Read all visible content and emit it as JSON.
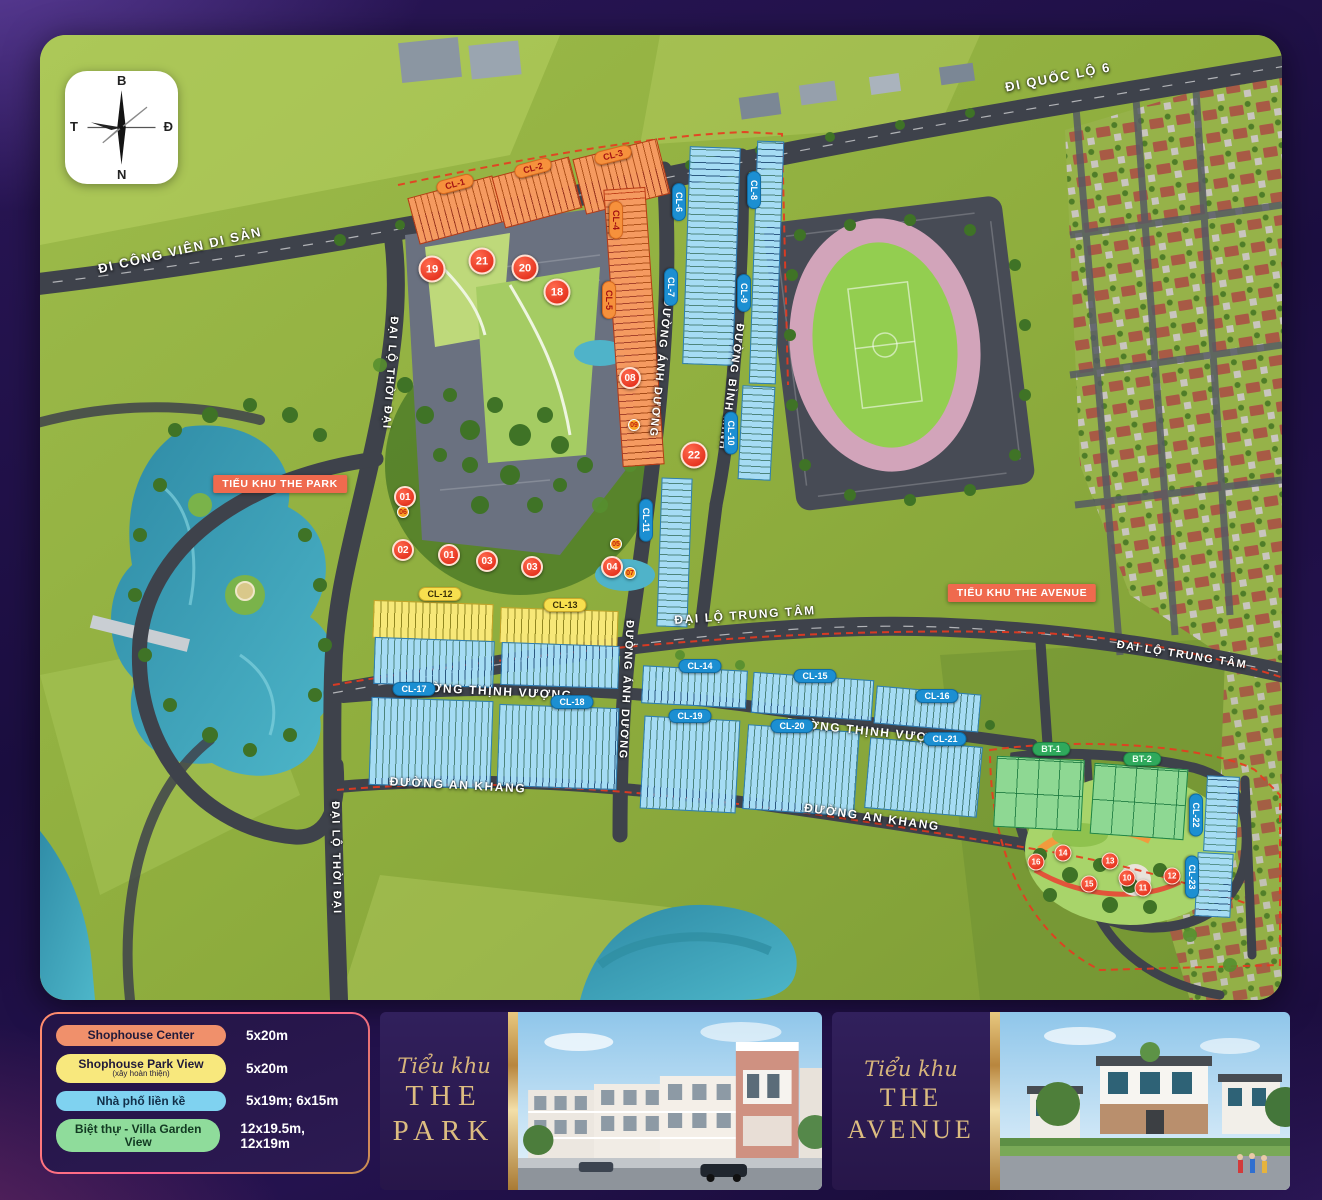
{
  "compass": {
    "north": "B",
    "east": "Đ",
    "south": "N",
    "west": "T"
  },
  "map": {
    "area_labels": [
      {
        "id": "the-park",
        "text": "TIỂU KHU THE PARK",
        "x": 240,
        "y": 449
      },
      {
        "id": "the-avenue",
        "text": "TIỂU KHU THE AVENUE",
        "x": 982,
        "y": 558
      }
    ],
    "road_labels": [
      {
        "id": "di-cong-vien-di-san",
        "text": "ĐI CÔNG VIÊN DI SẢN",
        "x": 140,
        "y": 215,
        "rot": -13,
        "fs": 13
      },
      {
        "id": "di-quoc-lo-6",
        "text": "ĐI QUỐC LỘ 6",
        "x": 1018,
        "y": 42,
        "rot": -11,
        "fs": 13
      },
      {
        "id": "dai-lo-thoi-dai-top",
        "text": "ĐẠI LỘ THỜI ĐẠI",
        "x": 350,
        "y": 338,
        "rot": 94,
        "fs": 11
      },
      {
        "id": "dai-lo-thoi-dai-bottom",
        "text": "ĐẠI LỘ THỜI ĐẠI",
        "x": 296,
        "y": 823,
        "rot": 89,
        "fs": 11
      },
      {
        "id": "duong-anh-duong-top",
        "text": "ĐƯỜNG ÁNH DƯƠNG",
        "x": 620,
        "y": 333,
        "rot": 96,
        "fs": 11
      },
      {
        "id": "duong-anh-duong-mid",
        "text": "ĐƯỜNG ÁNH DƯƠNG",
        "x": 586,
        "y": 655,
        "rot": 93,
        "fs": 11
      },
      {
        "id": "duong-binh-minh",
        "text": "ĐƯỜNG BÌNH MINH",
        "x": 691,
        "y": 352,
        "rot": 98,
        "fs": 11
      },
      {
        "id": "dai-lo-trung-tam-center",
        "text": "ĐẠI LỘ TRUNG TÂM",
        "x": 705,
        "y": 580,
        "rot": -4,
        "fs": 12
      },
      {
        "id": "dai-lo-trung-tam-right",
        "text": "ĐẠI LỘ TRUNG TÂM",
        "x": 1142,
        "y": 620,
        "rot": 9,
        "fs": 11
      },
      {
        "id": "duong-thinh-vuong-left",
        "text": "ĐƯỜNG THỊNH VƯỢNG",
        "x": 451,
        "y": 656,
        "rot": 3,
        "fs": 12
      },
      {
        "id": "duong-thinh-vuong-right",
        "text": "ĐƯỜNG THỊNH VƯỢNG",
        "x": 828,
        "y": 696,
        "rot": 6,
        "fs": 12
      },
      {
        "id": "duong-an-khang-left",
        "text": "ĐƯỜNG AN KHANG",
        "x": 418,
        "y": 750,
        "rot": 3,
        "fs": 12
      },
      {
        "id": "duong-an-khang-right",
        "text": "ĐƯỜNG AN KHANG",
        "x": 832,
        "y": 782,
        "rot": 8,
        "fs": 12
      }
    ],
    "block_labels": [
      {
        "id": "cl-1",
        "text": "CL-1",
        "x": 415,
        "y": 149,
        "rot": -15,
        "c": "orange"
      },
      {
        "id": "cl-2",
        "text": "CL-2",
        "x": 493,
        "y": 133,
        "rot": -15,
        "c": "orange"
      },
      {
        "id": "cl-3",
        "text": "CL-3",
        "x": 573,
        "y": 120,
        "rot": -14,
        "c": "orange"
      },
      {
        "id": "cl-4",
        "text": "CL-4",
        "x": 576,
        "y": 185,
        "rot": 90,
        "c": "orange"
      },
      {
        "id": "cl-5",
        "text": "CL-5",
        "x": 569,
        "y": 265,
        "rot": 90,
        "c": "orange"
      },
      {
        "id": "cl-6",
        "text": "CL-6",
        "x": 639,
        "y": 167,
        "rot": 90,
        "c": "blue"
      },
      {
        "id": "cl-7",
        "text": "CL-7",
        "x": 631,
        "y": 252,
        "rot": 90,
        "c": "blue"
      },
      {
        "id": "cl-8",
        "text": "CL-8",
        "x": 714,
        "y": 155,
        "rot": 90,
        "c": "blue"
      },
      {
        "id": "cl-9",
        "text": "CL-9",
        "x": 704,
        "y": 258,
        "rot": 90,
        "c": "blue"
      },
      {
        "id": "cl-10",
        "text": "CL-10",
        "x": 691,
        "y": 398,
        "rot": 90,
        "c": "blue"
      },
      {
        "id": "cl-11",
        "text": "CL-11",
        "x": 606,
        "y": 485,
        "rot": 90,
        "c": "blue"
      },
      {
        "id": "cl-12",
        "text": "CL-12",
        "x": 400,
        "y": 559,
        "rot": 0,
        "c": "yellow"
      },
      {
        "id": "cl-13",
        "text": "CL-13",
        "x": 525,
        "y": 570,
        "rot": 0,
        "c": "yellow"
      },
      {
        "id": "cl-14",
        "text": "CL-14",
        "x": 660,
        "y": 631,
        "rot": 0,
        "c": "blue"
      },
      {
        "id": "cl-15",
        "text": "CL-15",
        "x": 775,
        "y": 641,
        "rot": 0,
        "c": "blue"
      },
      {
        "id": "cl-16",
        "text": "CL-16",
        "x": 897,
        "y": 661,
        "rot": 0,
        "c": "blue"
      },
      {
        "id": "cl-17",
        "text": "CL-17",
        "x": 374,
        "y": 654,
        "rot": 0,
        "c": "blue"
      },
      {
        "id": "cl-18",
        "text": "CL-18",
        "x": 532,
        "y": 667,
        "rot": 0,
        "c": "blue"
      },
      {
        "id": "cl-19",
        "text": "CL-19",
        "x": 650,
        "y": 681,
        "rot": 0,
        "c": "blue"
      },
      {
        "id": "cl-20",
        "text": "CL-20",
        "x": 752,
        "y": 691,
        "rot": 0,
        "c": "blue"
      },
      {
        "id": "cl-21",
        "text": "CL-21",
        "x": 905,
        "y": 704,
        "rot": 0,
        "c": "blue"
      },
      {
        "id": "bt-1",
        "text": "BT-1",
        "x": 1011,
        "y": 714,
        "rot": 0,
        "c": "green"
      },
      {
        "id": "bt-2",
        "text": "BT-2",
        "x": 1102,
        "y": 724,
        "rot": 0,
        "c": "green"
      },
      {
        "id": "cl-22",
        "text": "CL-22",
        "x": 1156,
        "y": 780,
        "rot": 90,
        "c": "blue"
      },
      {
        "id": "cl-23",
        "text": "CL-23",
        "x": 1152,
        "y": 842,
        "rot": 90,
        "c": "blue"
      }
    ],
    "blocks": [
      {
        "id": "cl-1",
        "x": 372,
        "y": 151,
        "w": 88,
        "h": 48,
        "rot": -15,
        "c": "orange",
        "dir": "v"
      },
      {
        "id": "cl-2",
        "x": 457,
        "y": 131,
        "w": 80,
        "h": 53,
        "rot": -15,
        "c": "orange",
        "dir": "v"
      },
      {
        "id": "cl-3",
        "x": 538,
        "y": 113,
        "w": 87,
        "h": 57,
        "rot": -14,
        "c": "orange",
        "dir": "v"
      },
      {
        "id": "cl-4-5",
        "x": 573,
        "y": 153,
        "w": 42,
        "h": 278,
        "rot": -4,
        "c": "orange",
        "dir": "h"
      },
      {
        "id": "cl-6-7",
        "x": 646,
        "y": 112,
        "w": 51,
        "h": 218,
        "rot": 2,
        "c": "blue",
        "dir": "h"
      },
      {
        "id": "cl-8-9",
        "x": 713,
        "y": 106,
        "w": 27,
        "h": 243,
        "rot": 2,
        "c": "blue",
        "dir": "h"
      },
      {
        "id": "cl-10",
        "x": 700,
        "y": 351,
        "w": 33,
        "h": 94,
        "rot": 3,
        "c": "blue",
        "dir": "h"
      },
      {
        "id": "cl-11",
        "x": 619,
        "y": 443,
        "w": 31,
        "h": 149,
        "rot": 2,
        "c": "blue",
        "dir": "h"
      },
      {
        "id": "cl-12-sh",
        "x": 333,
        "y": 567,
        "w": 120,
        "h": 38,
        "rot": 2,
        "c": "yellow",
        "dir": "v"
      },
      {
        "id": "cl-12-lk",
        "x": 334,
        "y": 604,
        "w": 120,
        "h": 47,
        "rot": 2,
        "c": "blue",
        "dir": "v"
      },
      {
        "id": "cl-13-sh",
        "x": 460,
        "y": 574,
        "w": 118,
        "h": 36,
        "rot": 2,
        "c": "yellow",
        "dir": "v"
      },
      {
        "id": "cl-13-lk",
        "x": 461,
        "y": 609,
        "w": 118,
        "h": 43,
        "rot": 2,
        "c": "blue",
        "dir": "v"
      },
      {
        "id": "cl-17",
        "x": 330,
        "y": 664,
        "w": 122,
        "h": 88,
        "rot": 2,
        "c": "blue",
        "dir": "v"
      },
      {
        "id": "cl-18",
        "x": 458,
        "y": 671,
        "w": 120,
        "h": 82,
        "rot": 2,
        "c": "blue",
        "dir": "v"
      },
      {
        "id": "cl-14",
        "x": 602,
        "y": 633,
        "w": 105,
        "h": 38,
        "rot": 3,
        "c": "blue",
        "dir": "v"
      },
      {
        "id": "cl-15",
        "x": 712,
        "y": 641,
        "w": 121,
        "h": 41,
        "rot": 4,
        "c": "blue",
        "dir": "v"
      },
      {
        "id": "cl-16",
        "x": 835,
        "y": 655,
        "w": 105,
        "h": 38,
        "rot": 5,
        "c": "blue",
        "dir": "v"
      },
      {
        "id": "cl-19",
        "x": 602,
        "y": 683,
        "w": 96,
        "h": 93,
        "rot": 3,
        "c": "blue",
        "dir": "v"
      },
      {
        "id": "cl-20",
        "x": 705,
        "y": 693,
        "w": 112,
        "h": 85,
        "rot": 4,
        "c": "blue",
        "dir": "v"
      },
      {
        "id": "cl-21",
        "x": 827,
        "y": 707,
        "w": 113,
        "h": 71,
        "rot": 5,
        "c": "blue",
        "dir": "v"
      },
      {
        "id": "bt-1",
        "x": 955,
        "y": 723,
        "w": 88,
        "h": 71,
        "rot": 3,
        "c": "green",
        "dir": "g"
      },
      {
        "id": "bt-2",
        "x": 1052,
        "y": 731,
        "w": 94,
        "h": 71,
        "rot": 4,
        "c": "green",
        "dir": "g"
      },
      {
        "id": "cl-22",
        "x": 1165,
        "y": 741,
        "w": 33,
        "h": 76,
        "rot": 3,
        "c": "blue",
        "dir": "h"
      },
      {
        "id": "cl-23",
        "x": 1156,
        "y": 818,
        "w": 36,
        "h": 64,
        "rot": 3,
        "c": "blue",
        "dir": "h"
      }
    ],
    "markers": [
      {
        "n": "19",
        "x": 392,
        "y": 234,
        "s": "lg"
      },
      {
        "n": "21",
        "x": 442,
        "y": 226,
        "s": "lg"
      },
      {
        "n": "20",
        "x": 485,
        "y": 233,
        "s": "lg"
      },
      {
        "n": "18",
        "x": 517,
        "y": 257,
        "s": "lg"
      },
      {
        "n": "08",
        "x": 590,
        "y": 343,
        "s": "md"
      },
      {
        "n": "09",
        "x": 594,
        "y": 390,
        "s": "xs"
      },
      {
        "n": "22",
        "x": 654,
        "y": 420,
        "s": "lg"
      },
      {
        "n": "01",
        "x": 365,
        "y": 462,
        "s": "md"
      },
      {
        "n": "06",
        "x": 363,
        "y": 477,
        "s": "xs"
      },
      {
        "n": "02",
        "x": 363,
        "y": 515,
        "s": "md"
      },
      {
        "n": "01",
        "x": 409,
        "y": 520,
        "s": "md"
      },
      {
        "n": "03",
        "x": 447,
        "y": 526,
        "s": "md"
      },
      {
        "n": "03",
        "x": 492,
        "y": 532,
        "s": "md"
      },
      {
        "n": "05",
        "x": 576,
        "y": 509,
        "s": "xs"
      },
      {
        "n": "04",
        "x": 572,
        "y": 532,
        "s": "md"
      },
      {
        "n": "07",
        "x": 590,
        "y": 538,
        "s": "xs"
      },
      {
        "n": "16",
        "x": 996,
        "y": 827,
        "s": "sm"
      },
      {
        "n": "14",
        "x": 1023,
        "y": 818,
        "s": "sm"
      },
      {
        "n": "13",
        "x": 1070,
        "y": 826,
        "s": "sm"
      },
      {
        "n": "15",
        "x": 1049,
        "y": 849,
        "s": "sm"
      },
      {
        "n": "10",
        "x": 1087,
        "y": 843,
        "s": "sm"
      },
      {
        "n": "11",
        "x": 1103,
        "y": 853,
        "s": "sm"
      },
      {
        "n": "12",
        "x": 1132,
        "y": 841,
        "s": "sm"
      }
    ],
    "lot_value_samples": [
      "01/83.25",
      "04/76.8",
      "01/100.5",
      "01/234.0",
      "02/128.51"
    ]
  },
  "legend": {
    "rows": [
      {
        "label": "Shophouse Center",
        "sub": "",
        "size": "5x20m",
        "pill": "#f0906b",
        "text": "#201a3a"
      },
      {
        "label": "Shophouse Park View",
        "sub": "(xây hoàn thiện)",
        "size": "5x20m",
        "pill": "#f8e87d",
        "text": "#201a3a"
      },
      {
        "label": "Nhà phố liền kề",
        "sub": "",
        "size": "5x19m; 6x15m",
        "pill": "#7fd2f0",
        "text": "#12304a"
      },
      {
        "label": "Biệt thự - Villa Garden View",
        "sub": "",
        "size": "12x19.5m, 12x19m",
        "pill": "#8fdc9b",
        "text": "#123a22"
      }
    ]
  },
  "panels": [
    {
      "script": "Tiểu khu",
      "line1": "THE",
      "line2": "PARK"
    },
    {
      "script": "Tiểu khu",
      "line1": "THE",
      "line2": "AVENUE"
    }
  ],
  "colors": {
    "shophouse_center": "#f0906b",
    "shophouse_park_view": "#f8e87d",
    "nha_pho_lien_ke": "#7fd2f0",
    "biet_thu_villa": "#8fdc9b",
    "accent_label": "#ef6a4e",
    "gold": "#d7b57b"
  }
}
